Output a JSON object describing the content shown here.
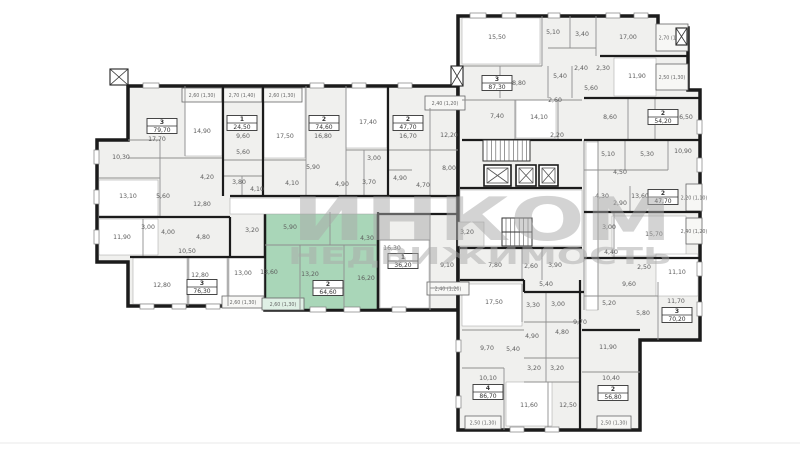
{
  "watermark": {
    "line1": "ИНКОМ",
    "line2": "НЕДВИЖИМОСТЬ"
  },
  "selected_apartment": {
    "rooms_count": "2",
    "area": "64,60"
  },
  "colors": {
    "wall": "#1b1b1b",
    "partition": "#8f8f8f",
    "base": "#f0f0ee",
    "white": "#ffffff",
    "highlight": "#a9d6b8",
    "label": "#5d5d5d",
    "watermark": "#a9a9a9",
    "balcony": "#f7f7f5"
  },
  "plan": {
    "divider_y": 443,
    "areas": [
      {
        "name": "left-wing-outline",
        "d": "M128,86 H458 V310 H265 V306 H128 V262 H97 V140 H128 Z",
        "fill": "#f0f0ee",
        "stroke": "#1b1b1b",
        "sw": 3.5,
        "inter": false
      },
      {
        "name": "right-wing-outline",
        "d": "M458,16 H658 V28 H688 V90 H700 V340 H640 V430 H458 Z",
        "fill": "#f0f0ee",
        "stroke": "#1b1b1b",
        "sw": 3.5,
        "inter": false
      },
      {
        "name": "selected-apartment",
        "d": "M265,212 H378 V310 H265 Z",
        "fill": "#a9d6b8",
        "stroke": "#1b1b1b",
        "sw": 2.5,
        "inter": true
      }
    ],
    "rooms": [
      [
        185,
        88,
        37,
        68
      ],
      [
        264,
        88,
        41,
        70
      ],
      [
        346,
        88,
        41,
        60
      ],
      [
        99,
        180,
        59,
        36
      ],
      [
        99,
        219,
        59,
        36
      ],
      [
        133,
        258,
        54,
        46
      ],
      [
        189,
        258,
        38,
        46
      ],
      [
        229,
        258,
        35,
        46
      ],
      [
        380,
        240,
        49,
        68
      ],
      [
        230,
        198,
        226,
        16
      ],
      [
        462,
        18,
        78,
        46
      ],
      [
        614,
        58,
        42,
        38
      ],
      [
        516,
        100,
        40,
        38
      ],
      [
        612,
        216,
        74,
        40
      ],
      [
        656,
        254,
        42,
        42
      ],
      [
        462,
        284,
        60,
        42
      ],
      [
        506,
        382,
        46,
        44
      ],
      [
        586,
        142,
        12,
        168
      ],
      [
        460,
        190,
        122,
        56
      ],
      [
        458,
        222,
        26,
        24,
        "#e8e8e6"
      ]
    ],
    "partitions": [
      [
        185,
        86,
        185,
        156
      ],
      [
        128,
        158,
        222,
        158
      ],
      [
        128,
        140,
        160,
        140
      ],
      [
        160,
        140,
        160,
        217
      ],
      [
        99,
        178,
        160,
        178
      ],
      [
        223,
        160,
        263,
        160
      ],
      [
        223,
        176,
        263,
        176
      ],
      [
        242,
        176,
        242,
        196
      ],
      [
        263,
        160,
        306,
        160
      ],
      [
        306,
        86,
        306,
        196
      ],
      [
        346,
        86,
        346,
        196
      ],
      [
        346,
        150,
        388,
        150
      ],
      [
        364,
        150,
        364,
        196
      ],
      [
        388,
        150,
        430,
        150
      ],
      [
        430,
        108,
        430,
        196
      ],
      [
        430,
        150,
        458,
        150
      ],
      [
        388,
        170,
        412,
        170
      ],
      [
        143,
        219,
        143,
        256
      ],
      [
        188,
        258,
        188,
        306
      ],
      [
        228,
        258,
        228,
        306
      ],
      [
        265,
        245,
        378,
        245
      ],
      [
        300,
        245,
        300,
        310
      ],
      [
        344,
        245,
        344,
        310
      ],
      [
        330,
        212,
        330,
        245
      ],
      [
        430,
        214,
        430,
        310
      ],
      [
        430,
        288,
        458,
        288
      ],
      [
        378,
        240,
        430,
        240
      ],
      [
        542,
        16,
        542,
        66
      ],
      [
        570,
        16,
        570,
        48
      ],
      [
        596,
        16,
        596,
        56
      ],
      [
        462,
        66,
        542,
        66
      ],
      [
        548,
        48,
        596,
        48
      ],
      [
        500,
        66,
        500,
        98
      ],
      [
        548,
        66,
        548,
        98
      ],
      [
        572,
        66,
        572,
        98
      ],
      [
        462,
        100,
        582,
        100
      ],
      [
        515,
        100,
        515,
        140
      ],
      [
        558,
        100,
        558,
        140
      ],
      [
        628,
        98,
        628,
        140
      ],
      [
        655,
        98,
        655,
        140
      ],
      [
        625,
        140,
        625,
        170
      ],
      [
        668,
        140,
        668,
        170
      ],
      [
        584,
        170,
        668,
        170
      ],
      [
        614,
        212,
        614,
        258
      ],
      [
        630,
        186,
        630,
        212
      ],
      [
        584,
        140,
        584,
        310
      ],
      [
        598,
        140,
        598,
        310
      ],
      [
        658,
        282,
        658,
        340
      ],
      [
        584,
        296,
        658,
        296
      ],
      [
        582,
        372,
        640,
        372
      ],
      [
        522,
        284,
        522,
        322
      ],
      [
        546,
        292,
        546,
        322
      ],
      [
        524,
        322,
        580,
        322
      ],
      [
        546,
        322,
        546,
        358
      ],
      [
        524,
        358,
        580,
        358
      ],
      [
        546,
        358,
        546,
        382
      ],
      [
        524,
        382,
        580,
        382
      ],
      [
        548,
        382,
        548,
        430
      ],
      [
        504,
        368,
        504,
        430
      ],
      [
        462,
        368,
        504,
        368
      ],
      [
        462,
        330,
        524,
        330
      ],
      [
        522,
        248,
        522,
        280
      ],
      [
        542,
        248,
        542,
        280
      ]
    ],
    "walls": [
      [
        223,
        86,
        223,
        196
      ],
      [
        263,
        86,
        263,
        196
      ],
      [
        388,
        86,
        388,
        196
      ],
      [
        230,
        196,
        458,
        196
      ],
      [
        99,
        217,
        230,
        217
      ],
      [
        230,
        217,
        230,
        258
      ],
      [
        130,
        257,
        265,
        257
      ],
      [
        378,
        214,
        458,
        214
      ],
      [
        378,
        212,
        378,
        310
      ],
      [
        600,
        56,
        688,
        56
      ],
      [
        584,
        98,
        700,
        98
      ],
      [
        584,
        140,
        700,
        140
      ],
      [
        584,
        212,
        700,
        212
      ],
      [
        584,
        258,
        700,
        258
      ],
      [
        462,
        140,
        582,
        140
      ],
      [
        460,
        188,
        582,
        188
      ],
      [
        460,
        248,
        582,
        248
      ],
      [
        460,
        280,
        524,
        280
      ],
      [
        524,
        280,
        524,
        292
      ],
      [
        524,
        292,
        584,
        292
      ],
      [
        580,
        280,
        580,
        430
      ],
      [
        582,
        330,
        640,
        330
      ]
    ],
    "windows": [
      [
        143,
        83,
        16,
        5
      ],
      [
        310,
        83,
        14,
        5
      ],
      [
        352,
        83,
        14,
        5
      ],
      [
        398,
        83,
        14,
        5
      ],
      [
        140,
        304,
        14,
        5
      ],
      [
        172,
        304,
        14,
        5
      ],
      [
        206,
        304,
        14,
        5
      ],
      [
        310,
        307,
        16,
        5
      ],
      [
        344,
        307,
        16,
        5
      ],
      [
        392,
        307,
        14,
        5
      ],
      [
        94,
        150,
        5,
        14
      ],
      [
        94,
        190,
        5,
        14
      ],
      [
        94,
        230,
        5,
        14
      ],
      [
        470,
        13,
        16,
        5
      ],
      [
        502,
        13,
        14,
        5
      ],
      [
        548,
        13,
        12,
        5
      ],
      [
        606,
        13,
        14,
        5
      ],
      [
        634,
        13,
        14,
        5
      ],
      [
        697,
        120,
        5,
        14
      ],
      [
        697,
        158,
        5,
        14
      ],
      [
        697,
        262,
        5,
        14
      ],
      [
        697,
        302,
        5,
        14
      ],
      [
        510,
        427,
        14,
        5
      ],
      [
        545,
        427,
        14,
        5
      ],
      [
        456,
        340,
        5,
        12
      ],
      [
        456,
        396,
        5,
        12
      ]
    ],
    "balconies": [
      [
        182,
        88,
        40,
        14,
        "2,60 (1,30)"
      ],
      [
        222,
        88,
        40,
        14,
        "2,70 (1,40)"
      ],
      [
        262,
        88,
        40,
        14,
        "2,60 (1,30)"
      ],
      [
        425,
        96,
        40,
        14,
        "2,40 (1,20)"
      ],
      [
        222,
        296,
        42,
        12,
        "2,60 (1,30)"
      ],
      [
        262,
        298,
        42,
        12,
        "2,60 (1,30)",
        "#dff0e5"
      ],
      [
        427,
        282,
        42,
        13,
        "2,40 (1,20)"
      ],
      [
        656,
        24,
        32,
        27,
        "2,70 (1,40)"
      ],
      [
        656,
        64,
        32,
        26,
        "2,50 (1,30)"
      ],
      [
        686,
        184,
        16,
        27,
        "2,20 (1,10)"
      ],
      [
        686,
        218,
        16,
        26,
        "2,40 (1,20)"
      ],
      [
        597,
        416,
        34,
        13,
        "2,50 (1,30)"
      ],
      [
        465,
        416,
        36,
        13,
        "2,50 (1,30)"
      ]
    ],
    "elevators": [
      [
        484,
        165,
        27,
        21
      ],
      [
        516,
        165,
        20,
        21
      ],
      [
        539,
        165,
        19,
        21
      ]
    ],
    "shafts": [
      [
        676,
        28,
        11,
        17
      ],
      [
        451,
        66,
        12,
        20
      ],
      [
        110,
        69,
        18,
        16
      ]
    ],
    "stairs": [
      [
        483,
        140,
        47,
        21
      ],
      [
        502,
        218,
        30,
        28
      ]
    ],
    "labels": [
      [
        157,
        141,
        "17,70"
      ],
      [
        202,
        133,
        "14,90"
      ],
      [
        243,
        138,
        "9,60"
      ],
      [
        285,
        138,
        "17,50"
      ],
      [
        323,
        138,
        "16,80"
      ],
      [
        368,
        124,
        "17,40"
      ],
      [
        408,
        138,
        "16,70"
      ],
      [
        449,
        137,
        "12,20"
      ],
      [
        121,
        159,
        "10,30"
      ],
      [
        128,
        198,
        "13,10"
      ],
      [
        163,
        198,
        "5,60"
      ],
      [
        202,
        206,
        "12,80"
      ],
      [
        207,
        179,
        "4,20"
      ],
      [
        243,
        154,
        "5,60"
      ],
      [
        239,
        184,
        "3,80"
      ],
      [
        257,
        191,
        "4,10"
      ],
      [
        292,
        185,
        "4,10"
      ],
      [
        313,
        169,
        "5,90"
      ],
      [
        374,
        160,
        "3,00"
      ],
      [
        342,
        186,
        "4,90"
      ],
      [
        369,
        184,
        "3,70"
      ],
      [
        400,
        180,
        "4,90"
      ],
      [
        423,
        187,
        "4,70"
      ],
      [
        449,
        170,
        "8,00"
      ],
      [
        122,
        239,
        "11,90"
      ],
      [
        148,
        229,
        "3,00"
      ],
      [
        168,
        234,
        "4,00"
      ],
      [
        203,
        239,
        "4,80"
      ],
      [
        187,
        253,
        "10,50"
      ],
      [
        252,
        232,
        "3,20"
      ],
      [
        162,
        287,
        "12,80"
      ],
      [
        200,
        277,
        "12,80"
      ],
      [
        243,
        275,
        "13,00"
      ],
      [
        290,
        229,
        "5,90"
      ],
      [
        367,
        240,
        "4,30"
      ],
      [
        269,
        274,
        "13,60"
      ],
      [
        310,
        276,
        "13,20"
      ],
      [
        366,
        280,
        "16,20"
      ],
      [
        392,
        250,
        "16,30"
      ],
      [
        447,
        267,
        "9,10"
      ],
      [
        467,
        234,
        "3,20"
      ],
      [
        495,
        267,
        "7,80"
      ],
      [
        531,
        268,
        "2,60"
      ],
      [
        555,
        267,
        "3,90"
      ],
      [
        546,
        286,
        "5,40"
      ],
      [
        497,
        39,
        "15,50"
      ],
      [
        553,
        34,
        "5,10"
      ],
      [
        582,
        36,
        "3,40"
      ],
      [
        628,
        39,
        "17,00"
      ],
      [
        517,
        85,
        "18,80"
      ],
      [
        560,
        78,
        "5,40"
      ],
      [
        581,
        70,
        "2,40"
      ],
      [
        603,
        70,
        "2,30"
      ],
      [
        591,
        90,
        "5,60"
      ],
      [
        637,
        78,
        "11,90"
      ],
      [
        555,
        102,
        "2,60"
      ],
      [
        497,
        118,
        "7,40"
      ],
      [
        539,
        119,
        "14,10"
      ],
      [
        557,
        137,
        "2,20"
      ],
      [
        610,
        119,
        "8,60"
      ],
      [
        684,
        119,
        "16,50"
      ],
      [
        608,
        156,
        "5,10"
      ],
      [
        647,
        156,
        "5,30"
      ],
      [
        683,
        153,
        "10,90"
      ],
      [
        620,
        174,
        "4,50"
      ],
      [
        602,
        198,
        "4,30"
      ],
      [
        620,
        205,
        "2,90"
      ],
      [
        640,
        198,
        "13,60"
      ],
      [
        609,
        229,
        "3,00"
      ],
      [
        654,
        236,
        "15,70"
      ],
      [
        611,
        254,
        "4,40"
      ],
      [
        644,
        269,
        "2,50"
      ],
      [
        677,
        274,
        "11,10"
      ],
      [
        629,
        286,
        "9,60"
      ],
      [
        609,
        305,
        "5,20"
      ],
      [
        643,
        315,
        "5,80"
      ],
      [
        676,
        303,
        "11,70"
      ],
      [
        608,
        349,
        "11,90"
      ],
      [
        611,
        380,
        "10,40"
      ],
      [
        494,
        304,
        "17,50"
      ],
      [
        533,
        307,
        "3,30"
      ],
      [
        558,
        306,
        "3,00"
      ],
      [
        580,
        324,
        "9,70"
      ],
      [
        532,
        338,
        "4,90"
      ],
      [
        562,
        334,
        "4,80"
      ],
      [
        487,
        350,
        "9,70"
      ],
      [
        513,
        351,
        "5,40"
      ],
      [
        534,
        370,
        "3,20"
      ],
      [
        557,
        370,
        "3,20"
      ],
      [
        488,
        380,
        "10,10"
      ],
      [
        529,
        407,
        "11,60"
      ],
      [
        568,
        407,
        "12,50"
      ]
    ],
    "tags": [
      [
        162,
        126,
        "3",
        "79,70",
        false
      ],
      [
        242,
        123,
        "1",
        "24,50",
        false
      ],
      [
        324,
        123,
        "2",
        "74,60",
        false
      ],
      [
        408,
        123,
        "2",
        "47,70",
        false
      ],
      [
        202,
        287,
        "3",
        "76,30",
        false
      ],
      [
        328,
        288,
        "2",
        "64,60",
        true
      ],
      [
        403,
        261,
        "1",
        "36,20",
        false
      ],
      [
        497,
        83,
        "3",
        "87,30",
        false
      ],
      [
        663,
        117,
        "2",
        "54,20",
        false
      ],
      [
        663,
        197,
        "2",
        "47,70",
        false
      ],
      [
        677,
        315,
        "3",
        "70,20",
        false
      ],
      [
        488,
        392,
        "4",
        "86,70",
        false
      ],
      [
        613,
        393,
        "2",
        "56,80",
        false
      ]
    ]
  }
}
